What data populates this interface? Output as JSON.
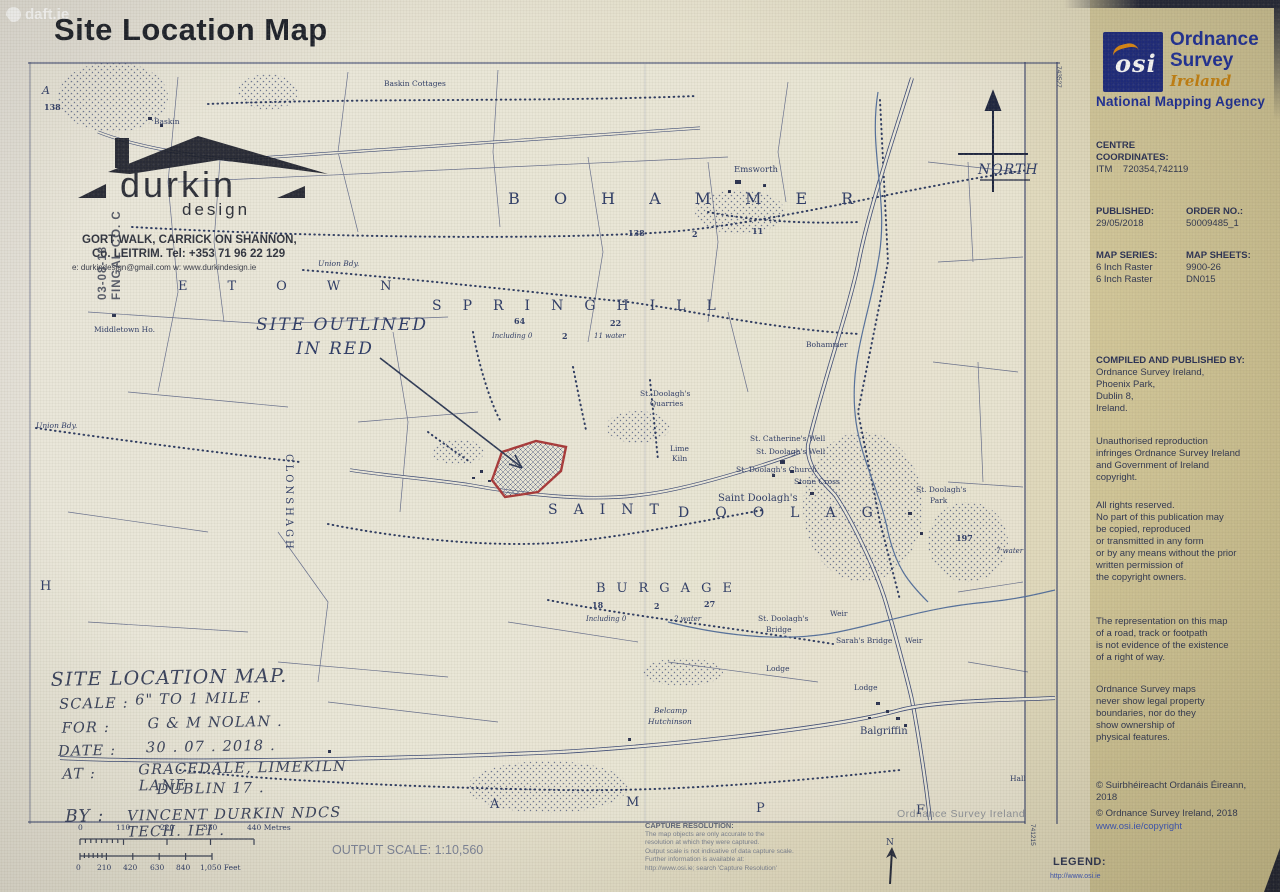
{
  "colors": {
    "osi_blue": "#1d2a7d",
    "osi_text_blue": "#1d2f9a",
    "osi_orange": "#c8820e",
    "site_outline_red": "#a83939",
    "map_ink": "#3c4a74",
    "paper": "#e7e4d4"
  },
  "photo": {
    "brand": "daft.ie"
  },
  "title": "Site Location Map",
  "map": {
    "note1": "SITE OUTLINED",
    "note2": "IN RED",
    "north": "NORTH",
    "watermark": "Ordnance Survey Ireland",
    "edge": {
      "top_right": "743527",
      "bottom_right": "741215"
    },
    "stamp": {
      "name": "durkin",
      "sub": "design",
      "addr1": "GORT WALK, CARRICK ON SHANNON,",
      "addr2": "Co. LEITRIM. Tel: +353 71 96 22 129",
      "addr3": "e: durkindesign@gmail.com    w: www.durkindesign.ie"
    },
    "datestamp": {
      "l1": "03-08-18",
      "l2": "FINGAL CO. C"
    },
    "townlands": {
      "t1": "BOHAMMER",
      "t2": "SPRINGHILL",
      "t3": "SAINT",
      "t4": "DOOLAG",
      "t5": "BURGAGE",
      "t6": "ETOWN",
      "t7": "CLONSHAGH"
    },
    "letters": {
      "l1": "H",
      "l2": "A",
      "l3": "M",
      "l4": "P",
      "l5": "F",
      "l6": "A"
    },
    "labels": {
      "baskin_cottages": "Baskin Cottages",
      "baskin": "Baskin",
      "emsworth": "Emsworth",
      "middletown": "Middletown Ho.",
      "union_bdy1": "Union Bdy.",
      "union_bdy2": "Union Bdy.",
      "bohammer_ho": "Bohammer",
      "quarries1": "St. Doolagh's",
      "quarries2": "Quarries",
      "lime1": "Lime",
      "lime2": "Kiln",
      "catherines": "St. Catherine's Well",
      "doolaghs_well": "St. Doolagh's Well",
      "church": "St. Doolagh's Church",
      "stone_cross": "Stone Cross",
      "saint_doolaghs": "Saint Doolagh's",
      "park1": "St. Doolagh's",
      "park2": "Park",
      "bridge1": "St. Doolagh's",
      "bridge2": "Bridge",
      "weir1": "Weir",
      "weir2": "Weir",
      "sarahs": "Sarah's Bridge",
      "balgriffin": "Balgriffin",
      "belcamp1": "Belcamp",
      "belcamp2": "Hutchinson",
      "lodge1": "Lodge",
      "lodge2": "Lodge",
      "hall": "Hall"
    },
    "numbers": {
      "topA": "A",
      "a138": "138",
      "n138": "138",
      "n2": "2",
      "n11": "11",
      "n64": "64",
      "n22": "22",
      "inc0": "Including 0",
      "n2b": "2",
      "w11": "11 water",
      "n18": "18",
      "inc0b": "Including 0",
      "n2c": "2",
      "n27": "27",
      "w2": "2 water",
      "n197": "197",
      "w7": "7 water"
    }
  },
  "notes": {
    "heading": "SITE LOCATION MAP.",
    "rows": [
      {
        "label": "SCALE :",
        "value": "6\" TO 1 MILE ."
      },
      {
        "label": "FOR :",
        "value": "G & M NOLAN ."
      },
      {
        "label": "DATE :",
        "value": "30 . 07 . 2018 ."
      },
      {
        "label": "AT :",
        "value": "GRACEDALE, LIMEKILN LANE"
      },
      {
        "label": "",
        "value": "DUBLIN 17 ."
      },
      {
        "label": "BY :",
        "value": "VINCENT DURKIN  NDCS TECH. IEI ."
      }
    ]
  },
  "scalebar": {
    "metres": [
      "0",
      "110",
      "220",
      "330",
      "440 Metres"
    ],
    "feet": [
      "0",
      "210",
      "420",
      "630",
      "840",
      "1,050 Feet"
    ]
  },
  "output_scale": {
    "label": "OUTPUT SCALE:",
    "value": "1:10,560"
  },
  "capture": {
    "heading": "CAPTURE RESOLUTION:",
    "l1": "The map objects are only accurate to the",
    "l2": "resolution at which they were captured.",
    "l3": "Output scale is not indicative of data capture scale.",
    "l4": "Further information is available at:",
    "l5": "http://www.osi.ie; search 'Capture Resolution'"
  },
  "panel": {
    "logo": {
      "word": "osi",
      "l1": "Ordnance",
      "l2": "Survey",
      "l3": "Ireland",
      "tagline": "National Mapping Agency"
    },
    "centre": {
      "h1": "CENTRE",
      "h2": "COORDINATES:",
      "itm_label": "ITM",
      "itm_value": "720354,742119"
    },
    "published": {
      "label": "PUBLISHED:",
      "value": "29/05/2018"
    },
    "order": {
      "label": "ORDER NO.:",
      "value": "50009485_1"
    },
    "series": {
      "label": "MAP SERIES:",
      "v1": "6 Inch Raster",
      "v2": "6 Inch Raster"
    },
    "sheets": {
      "label": "MAP SHEETS:",
      "v1": "9900-26",
      "v2": "DN015"
    },
    "compiled": {
      "label": "COMPILED AND PUBLISHED BY:",
      "l1": "Ordnance Survey Ireland,",
      "l2": "Phoenix Park,",
      "l3": "Dublin 8,",
      "l4": "Ireland."
    },
    "notice": {
      "l1": "Unauthorised reproduction",
      "l2": "infringes Ordnance Survey Ireland",
      "l3": "and Government of Ireland",
      "l4": "copyright."
    },
    "rights": {
      "l1": "All rights reserved.",
      "l2": "No part of this publication may",
      "l3": "be copied, reproduced",
      "l4": "or transmitted in any form",
      "l5": "or by any means without the prior",
      "l6": "written permission of",
      "l7": "the copyright owners."
    },
    "rep": {
      "l1": "The representation on this map",
      "l2": "of a road, track or footpath",
      "l3": "is not evidence of the existence",
      "l4": "of a right of way."
    },
    "bound": {
      "l1": "Ordnance Survey maps",
      "l2": "never show legal property",
      "l3": "boundaries, nor do they",
      "l4": "show ownership of",
      "l5": "physical features."
    },
    "copy1": {
      "l1": "© Suirbhéireacht Ordanáis Éireann,",
      "l2": "2018"
    },
    "copy2": "© Ordnance Survey Ireland,  2018",
    "link": "www.osi.ie/copyright"
  },
  "legend": {
    "label": "LEGEND:",
    "link": "http://www.osi.ie"
  }
}
